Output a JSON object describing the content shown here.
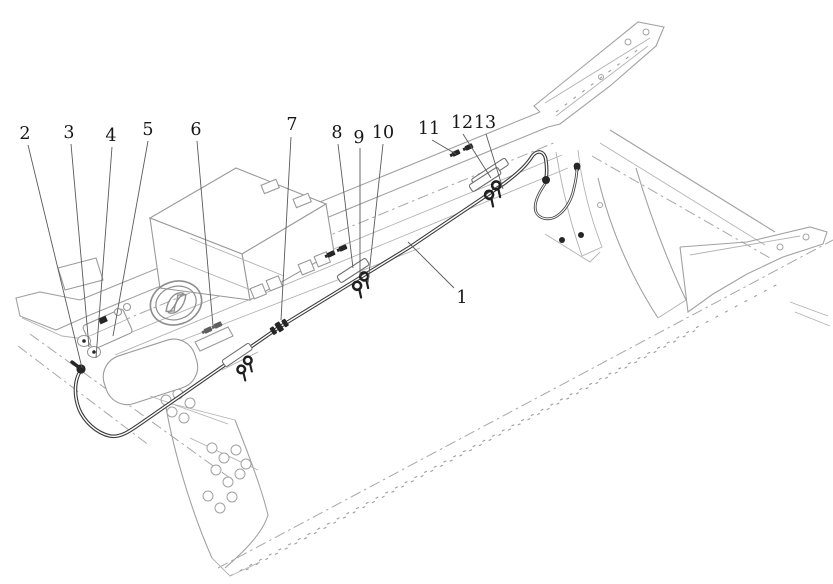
{
  "figure": {
    "kind": "exploded-parts-line-drawing",
    "subject": "truck chassis frame with brake pipe assembly, clamps and fittings"
  },
  "colors": {
    "background": "#ffffff",
    "frame_line": "#a2a2a2",
    "pipe_line": "#3a3a3a",
    "hardware": "#1f1f1f",
    "leader_line": "#5a5a5a",
    "label_text": "#161616"
  },
  "icons": {
    "brand_logo": "circular-swoosh-emblem"
  },
  "callouts": [
    {
      "label": "1"
    },
    {
      "label": "2"
    },
    {
      "label": "3"
    },
    {
      "label": "4"
    },
    {
      "label": "5"
    },
    {
      "label": "6"
    },
    {
      "label": "7"
    },
    {
      "label": "8"
    },
    {
      "label": "9"
    },
    {
      "label": "10"
    },
    {
      "label": "11"
    },
    {
      "label": "12"
    },
    {
      "label": "13"
    }
  ]
}
